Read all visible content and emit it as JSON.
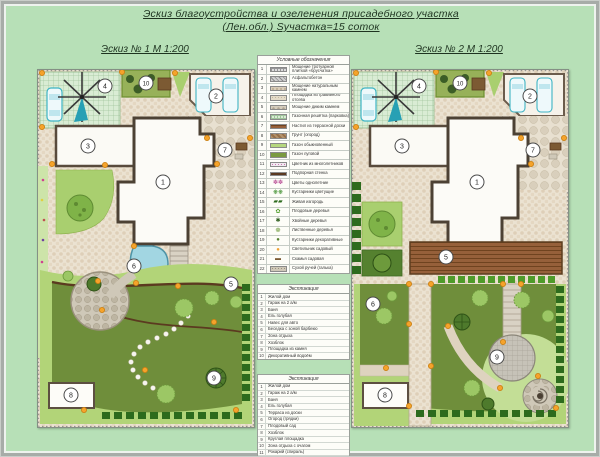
{
  "title": {
    "line1": "Эскиз благоустройства и озеленения присадебного участка",
    "line2": "(Лен.обл.) Sучастка=15 соток"
  },
  "plans": {
    "plan1": {
      "header": "Эскиз № 1 М 1:200",
      "markers": [
        {
          "label": "1",
          "x": 125,
          "y": 112
        },
        {
          "label": "2",
          "x": 178,
          "y": 26
        },
        {
          "label": "3",
          "x": 50,
          "y": 76
        },
        {
          "label": "4",
          "x": 67,
          "y": 16
        },
        {
          "label": "5",
          "x": 193,
          "y": 214
        },
        {
          "label": "6",
          "x": 96,
          "y": 196
        },
        {
          "label": "7",
          "x": 187,
          "y": 80
        },
        {
          "label": "8",
          "x": 33,
          "y": 325
        },
        {
          "label": "9",
          "x": 176,
          "y": 308
        },
        {
          "label": "10",
          "x": 108,
          "y": 13
        }
      ]
    },
    "plan2": {
      "header": "Эскиз № 2 М 1:200",
      "markers": [
        {
          "label": "1",
          "x": 125,
          "y": 112
        },
        {
          "label": "2",
          "x": 178,
          "y": 26
        },
        {
          "label": "3",
          "x": 50,
          "y": 76
        },
        {
          "label": "4",
          "x": 67,
          "y": 16
        },
        {
          "label": "5",
          "x": 94,
          "y": 187
        },
        {
          "label": "6",
          "x": 21,
          "y": 234
        },
        {
          "label": "7",
          "x": 181,
          "y": 80
        },
        {
          "label": "8",
          "x": 33,
          "y": 325
        },
        {
          "label": "9",
          "x": 145,
          "y": 287
        },
        {
          "label": "10",
          "x": 108,
          "y": 13
        }
      ]
    }
  },
  "legend": {
    "title": "Условные обозначения",
    "rows": [
      {
        "n": "1",
        "swatch": "paving",
        "label": "Мощение тротуарной плиткой «брусчатка»"
      },
      {
        "n": "2",
        "swatch": "asphalt",
        "label": "Асфальтобетон"
      },
      {
        "n": "3",
        "swatch": "stone",
        "label": "Мощение натуральным камнем"
      },
      {
        "n": "4",
        "swatch": "gravel",
        "label": "Площадка из гравийного отсева"
      },
      {
        "n": "5",
        "swatch": "bigstone",
        "label": "Мощение диким камнем"
      },
      {
        "n": "6",
        "swatch": "grid",
        "label": "Газонная решётка (парковка)"
      },
      {
        "n": "7",
        "swatch": "wood",
        "label": "Настил из террасной доски"
      },
      {
        "n": "8",
        "swatch": "soil",
        "label": "Грунт (огород)"
      },
      {
        "n": "9",
        "swatch": "lawn-light",
        "label": "Газон обыкновенный"
      },
      {
        "n": "10",
        "swatch": "lawn-dark",
        "label": "Газон луговой"
      },
      {
        "n": "11",
        "swatch": "flowerbed",
        "label": "Цветник из многолетников"
      },
      {
        "n": "12",
        "swatch": "wall",
        "label": "Подпорная стенка"
      },
      {
        "n": "13",
        "swatch": "flowers",
        "label": "Цветы однолетние"
      },
      {
        "n": "14",
        "swatch": "shrub-flowering",
        "label": "Кустарники цветущие"
      },
      {
        "n": "15",
        "swatch": "hedge",
        "label": "Живая изгородь"
      },
      {
        "n": "16",
        "swatch": "tree-fruit",
        "label": "Плодовые деревья"
      },
      {
        "n": "17",
        "swatch": "conifer",
        "label": "Хвойные деревья"
      },
      {
        "n": "18",
        "swatch": "tree",
        "label": "Лиственные деревья"
      },
      {
        "n": "19",
        "swatch": "shrub",
        "label": "Кустарники декоративные"
      },
      {
        "n": "20",
        "swatch": "lamp",
        "label": "Светильник садовый"
      },
      {
        "n": "21",
        "swatch": "bench",
        "label": "Скамья садовая"
      },
      {
        "n": "22",
        "swatch": "stream",
        "label": "Сухой ручей (галька)"
      }
    ]
  },
  "explication1": {
    "title": "Экспликация",
    "items": [
      "Жилой дом",
      "Гараж на 2 а/м",
      "Баня",
      "Ель голубая",
      "Навес для авто",
      "Беседка с зоной барбекю",
      "Зона отдыха",
      "Хозблок",
      "Площадка из камня",
      "Декоративный водоём"
    ]
  },
  "explication2": {
    "title": "Экспликация",
    "items": [
      "Жилой дом",
      "Гараж на 2 а/м",
      "Баня",
      "Ель голубая",
      "Терраса из доски",
      "Огород (грядки)",
      "Плодовый сад",
      "Хозблок",
      "Круглая площадка",
      "Зона отдыха с очагом",
      "Рокарий (спираль)",
      "Детская площадка",
      "Хозяйственная зона"
    ]
  },
  "colors": {
    "mat": "#b7e0b7",
    "paving": "#ebe2d1",
    "lawn_dark": "#6f8e3b",
    "lawn_light": "#b2d478",
    "hedge": "#2d6b1d",
    "pond": "#a2d6e2",
    "wood": "#96603a",
    "lamp": "#f5a32b",
    "car": "#3fb4c4",
    "wall": "#4c4134"
  }
}
